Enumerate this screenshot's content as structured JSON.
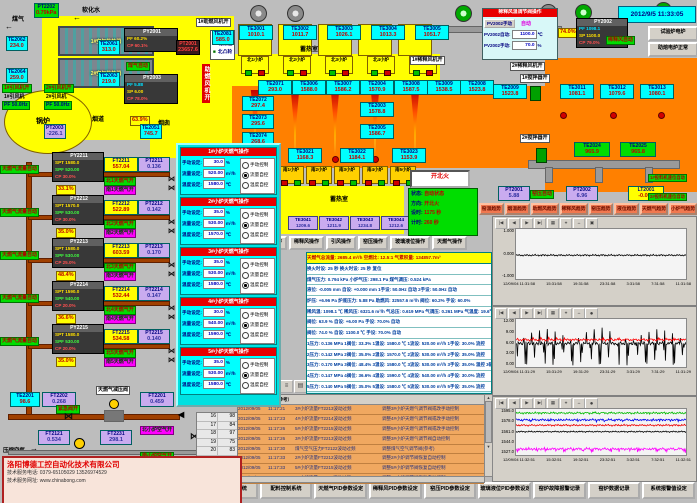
{
  "window": {
    "datetime": "2012/9/5 11:33:05"
  },
  "icons": {
    "left_arrow": "←",
    "right_arrow": "→",
    "pipe_arrow": "◀",
    "valve": "⋈",
    "marker": "▶",
    "up": "▲",
    "down": "▼",
    "left": "◀",
    "right": "▶",
    "record": "●"
  },
  "top_left": {
    "gas_label": "煤气",
    "water_label": "软化水",
    "boiler": "锅炉",
    "flue": "烟道",
    "chimney": "烟囱",
    "gas_auto": "煤气自动",
    "comb_fan_vert": "助燃风机开",
    "comb_fan1_on": "1#助燃风机开",
    "pt2202": {
      "id": "PT2202",
      "v": "0.79kPa"
    },
    "hx1": "1#空气换热器",
    "hx2": "2#空气换热器",
    "te2062": {
      "id": "TE2062",
      "v": "234.0"
    },
    "te2061": {
      "id": "TE2061",
      "v": "313.0"
    },
    "te2064": {
      "id": "TE2064",
      "v": "259.0"
    },
    "te2063": {
      "id": "TE2063",
      "v": "219.0"
    },
    "fan1_on": "1#引风机开",
    "fan2_on": "2#引风机开",
    "fan1": "1#引风机",
    "fan2": "2#引风机",
    "pf1": "PF 50.0Hz",
    "pf2": "PF 50.0Hz",
    "py2001": {
      "id": "PY2001",
      "r1": "PF 60.2%",
      "r2": "CP 60.1%"
    },
    "pt2001": {
      "id": "PT2001",
      "v": "23657.6"
    },
    "py2003": {
      "id": "PY2003",
      "r1": "PF 5.88",
      "r2": "SP 6.00",
      "r3": "CP 78.0%"
    },
    "valve_pos": "63.9%",
    "legend": [
      {
        "sq": "□",
        "t": "北行程"
      },
      {
        "sq": "□",
        "t": "北限位"
      },
      {
        "sq": "■",
        "t": "北凸轮"
      }
    ],
    "pt2003": {
      "id": "PT2003",
      "v": "-226.1"
    },
    "te2051": {
      "id": "TE2051",
      "v": "745.7"
    }
  },
  "regenerator": {
    "label": "蓄热室",
    "te2081": {
      "id": "TE2081",
      "v": "585.0"
    },
    "chambers": [
      {
        "id": "TE3001",
        "v": "1010.1"
      },
      {
        "id": "TE3002",
        "v": "1011.7"
      },
      {
        "id": "TE3003",
        "v": "1026.1"
      },
      {
        "id": "TE3004",
        "v": "1013.3"
      },
      {
        "id": "TE3005",
        "v": "1051.7"
      }
    ],
    "north_burners": [
      "北1小炉",
      "北2小炉",
      "北3小炉",
      "北4小炉",
      "北5小炉"
    ]
  },
  "furnace": {
    "top_sensors": [
      {
        "id": "TE2071",
        "v": "293.0"
      },
      {
        "id": "TE3006",
        "v": "1588.0"
      },
      {
        "id": "TE3007",
        "v": "1586.2"
      },
      {
        "id": "TE2004",
        "v": "1570.9"
      },
      {
        "id": "TE3008",
        "v": "1587.5"
      },
      {
        "id": "TE3009",
        "v": "1538.5"
      },
      {
        "id": "TE2008",
        "v": "1523.8"
      },
      {
        "id": "TE2009",
        "v": "1523.8"
      }
    ],
    "stack_sensors": [
      {
        "id": "TE2003",
        "v": "1578.8"
      },
      {
        "id": "TE2005",
        "v": "1586.7"
      }
    ],
    "left_sensors": [
      {
        "id": "TE2072",
        "v": "297.4"
      },
      {
        "id": "TE2073",
        "v": "295.6"
      },
      {
        "id": "TE2074",
        "v": "268.6"
      }
    ],
    "right_sensors": [
      {
        "id": "TE3011",
        "v": "1081.1"
      },
      {
        "id": "TE3012",
        "v": "1079.6"
      },
      {
        "id": "TE3013",
        "v": "1080.1"
      }
    ],
    "green_sensors": [
      {
        "id": "TE2024",
        "v": "965.9"
      },
      {
        "id": "TE2025",
        "v": "965.8"
      }
    ],
    "south_top_sensors": [
      {
        "id": "TE3021",
        "v": "1168.3"
      },
      {
        "id": "TE3022",
        "v": "1184.1"
      },
      {
        "id": "TE3023",
        "v": "1153.9"
      }
    ],
    "south_burners": [
      "南1小炉",
      "南2小炉",
      "南3小炉",
      "南4小炉",
      "南5小炉"
    ],
    "south_regen_label": "蓄热室",
    "purple_sensors": [
      {
        "id": "TE3041",
        "v": "1209.6"
      },
      {
        "id": "TE3042",
        "v": "1211.9"
      },
      {
        "id": "TE3043",
        "v": "1234.8"
      },
      {
        "id": "TE3044",
        "v": "1212.6"
      },
      {
        "id": "TE3045",
        "v": "1251.6"
      }
    ]
  },
  "right_top": {
    "dilution_panel": {
      "title": "稀释风温调节阀操作",
      "manual_btn": "PV2002手动",
      "auto_label": "自动",
      "row1_k": "PV2002自动:",
      "row1_v": "1100.0",
      "row1_u": "℃",
      "row2_k": "PV2002手动:",
      "row2_v": "70.0",
      "row2_u": "%"
    },
    "valve_pos": "74.0%",
    "pt2002a": {
      "id": "PT2002",
      "v": "6321.6"
    },
    "py2002": {
      "id": "PY2002",
      "r1": "PF 1098.1",
      "r2": "SP 1100.0",
      "r3": "CP 79.0%"
    },
    "dilution_auto": "稀释风自动",
    "fan1_on": "1#稀释风机开",
    "fan2_on": "2#稀释风机开",
    "stir1_on": "1#搅拌器开",
    "stir2_on": "2#搅拌器开",
    "test_btn": "试验炉电炉",
    "melt_btn": "助熔电炉正常",
    "pt2001": {
      "id": "PT2001",
      "v": "5.88"
    },
    "kiln_auto": "窑压自动",
    "pt2002b": {
      "id": "PT2002",
      "v": "6.96"
    },
    "lt2001": {
      "id": "LT2001",
      "v": "-0.001"
    },
    "feeder1": "1#投料机速位自动",
    "feeder2": "2#投料机速位自动"
  },
  "gas_rows": [
    {
      "auto": "天燃气流量自动",
      "py": {
        "id": "PY2211",
        "spt": "SPT 1580.0",
        "spf": "SPF 520.00",
        "cp": "CP 30.0%"
      },
      "ft": {
        "id": "FT2211",
        "v": "557.04"
      },
      "pt": {
        "id": "PT2211",
        "v": "0.136"
      },
      "north": "北1天燃气开",
      "south": "南1天燃气开",
      "pos": "33.1%"
    },
    {
      "auto": "天燃气流量自动",
      "py": {
        "id": "PY2212",
        "spt": "SPT 1570.0",
        "spf": "SPF 530.00",
        "cp": "CP 30.0%"
      },
      "ft": {
        "id": "FT2212",
        "v": "522.89"
      },
      "pt": {
        "id": "PT2212",
        "v": "0.142"
      },
      "north": "北2天燃气开",
      "south": "南2天燃气开",
      "pos": "35.0%"
    },
    {
      "auto": "天燃气流量自动",
      "py": {
        "id": "PY2213",
        "spt": "SPT 1580.0",
        "spf": "SPF 530.00",
        "cp": "CP 25.0%"
      },
      "ft": {
        "id": "FT2213",
        "v": "603.59"
      },
      "pt": {
        "id": "PT2213",
        "v": "0.170"
      },
      "north": "北3天燃气开",
      "south": "南3天燃气开",
      "pos": "48.4%"
    },
    {
      "auto": "天燃气流量自动",
      "py": {
        "id": "PY2214",
        "spt": "SPT 1590.0",
        "spf": "SPF 540.00",
        "cp": "CP 20.0%"
      },
      "ft": {
        "id": "FT2214",
        "v": "532.44"
      },
      "pt": {
        "id": "PT2214",
        "v": "0.147"
      },
      "north": "北4天燃气开",
      "south": "南4天燃气开",
      "pos": "36.6%"
    },
    {
      "auto": "天燃气流量自动",
      "py": {
        "id": "PY2215",
        "spt": "SPT 1580.0",
        "spf": "SPF 530.00",
        "cp": "CP 20.0%"
      },
      "ft": {
        "id": "FT2215",
        "v": "534.58"
      },
      "pt": {
        "id": "PT2215",
        "v": "0.140"
      },
      "north": "北5天燃气开",
      "south": "南5天燃气开",
      "pos": "35.0%"
    }
  ],
  "bottom_pipes": {
    "te2201": {
      "id": "TE2201",
      "v": "98.6"
    },
    "ft2202": {
      "id": "FT2202",
      "v": "0.268"
    },
    "emergency": "紧急阀开",
    "reducer": "天燃气减压阀",
    "ft2201": {
      "id": "FT2201",
      "v": "0.459"
    },
    "air_label": "压缩空气",
    "ft2121": {
      "id": "FT2121",
      "v": "0.534"
    },
    "ft2231": {
      "id": "FT2231",
      "v": "298.1"
    },
    "north_air": "北小炉空气开",
    "south_air": "南小炉空气开"
  },
  "company": {
    "name": "洛阳博德工控自动化技术有限公司",
    "phone": "技术服务电话: 0379-65105029  13526974529",
    "web": "技术服务网址: www.chinabong.com"
  },
  "popup": {
    "option_labels": [
      "手动控制",
      "流量自控",
      "温度自控"
    ],
    "field_labels": {
      "manual": "手动设定:",
      "flow": "流量设定:",
      "temp": "温度设定:"
    },
    "units": {
      "manual": "%",
      "flow": "m³/h",
      "temp": "℃"
    },
    "panels": [
      {
        "title": "1#小炉天燃气操作",
        "manual": "30.0",
        "flow": "520.00",
        "temp": "1580.0",
        "m0": "",
        "m1": "sel",
        "m2": ""
      },
      {
        "title": "2#小炉天燃气操作",
        "manual": "35.0",
        "flow": "530.00",
        "temp": "1570.0",
        "m0": "",
        "m1": "sel",
        "m2": ""
      },
      {
        "title": "3#小炉天燃气操作",
        "manual": "35.0",
        "flow": "530.00",
        "temp": "1580.0",
        "m0": "",
        "m1": "",
        "m2": "sel"
      },
      {
        "title": "4#小炉天燃气操作",
        "manual": "30.0",
        "flow": "540.00",
        "temp": "1590.0",
        "m0": "",
        "m1": "sel",
        "m2": ""
      },
      {
        "title": "5#小炉天燃气操作",
        "manual": "35.0",
        "flow": "530.00",
        "temp": "1580.0",
        "m0": "",
        "m1": "sel",
        "m2": ""
      }
    ]
  },
  "mid": {
    "fire_btn": "开北火",
    "status": [
      {
        "k": "状态:",
        "v": "自动状态"
      },
      {
        "k": "方向:",
        "v": "开北火"
      },
      {
        "k": "设时:",
        "v": "1175 秒"
      },
      {
        "k": "计时:",
        "v": "260 秒"
      }
    ],
    "op_buttons": [
      "助燃风操作",
      "稀释风操作",
      "引风操作",
      "窑压操作",
      "玻璃液位操作",
      "天燃气操作"
    ]
  },
  "summary": {
    "header": "天燃气总流量: 2685.4 m³/h   空燃比: 12.5:1   气累积量: 134857.7m³",
    "rows": [
      "换火时设: 25 秒    换火时设: 25 秒    复位",
      "煤气压力: 0.794 kPa   小炉气压: 298.1 Pa   煤气调压: 0.524 kPa",
      "液位: -0.005 mm   自设: +0.000 mm   1手设: 50.0Hz 自动   2手设: 50.0Hz 自动",
      "炉压: +6.96 Pa   炉底压力: 5.88 Pa   助燃风: 32557.6 m³/h   阀位: 60.2%   手设: 60.0%",
      "稀风温: 1098.1 ℃   稀风压: 6321.6 m³/h   气总压: 0.619 MPa   气调压: 0.261 MPa   气温度: 19.6℃",
      "阀位: 63.9 %   自设: +6.00 Pa   手设: 70.0%   自动",
      "阀位: 74.0 %   自设: 1100.0 ℃   手设: 70.0%   自动",
      "1压力: 0.136 MPa  1阀位: 33.3%  1温设: 1580.0 ℃  1流设: 520.00 m³/h  1手设: 30.0%  流控",
      "2压力: 0.142 MPa  2阀位: 35.0%  2温设: 1570.0 ℃  2流设: 530.00 m³/h  2手设: 35.0%  流控",
      "3压力: 0.170 MPa  3阀位: 48.4%  3温设: 1580.0 ℃  3流设: 530.00 m³/h  3手设: 35.0%  温控  3碹顶温度=1586.7℃",
      "4压力: 0.147 MPa  4阀位: 36.6%  4温设: 1590.0 ℃  4流设: 540.00 m³/h  4手设: 30.0%  流控",
      "5压力: 0.140 MPa  5阀位: 35.0%  5温设: 1580.0 ℃  5流设: 530.00 m³/h  5手设: 35.0%  流控"
    ]
  },
  "alarm": {
    "mini": [
      {
        "a": "16",
        "b": "98"
      },
      {
        "a": "17",
        "b": "84"
      },
      {
        "a": "18",
        "b": "97"
      },
      {
        "a": "19",
        "b": "75"
      },
      {
        "a": "20",
        "b": "83"
      },
      {
        "a": "21",
        "b": "85"
      },
      {
        "a": "22",
        "b": "81"
      },
      {
        "a": "23",
        "b": "83"
      }
    ],
    "headers": {
      "point": "故障点",
      "reason": "故障原因（供参考）"
    },
    "rows": [
      {
        "d": "2012/09/05",
        "t": "11:17:21",
        "p": "3#小炉流量FT2213波动过频",
        "r": "调整3#小炉天燃气调节阀或改手动控制"
      },
      {
        "d": "2012/09/05",
        "t": "11:17:23",
        "p": "4#小炉流量FT2214波动过频",
        "r": "调整4#小炉天燃气调节阀或改手动控制"
      },
      {
        "d": "2012/09/05",
        "t": "11:17:26",
        "p": "5#小炉流量FT2215波动过频",
        "r": "调整5#小炉天燃气调节阀或改手动控制"
      },
      {
        "d": "2012/09/05",
        "t": "11:17:26",
        "p": "3#小炉流量FT2213波动过频",
        "r": "调整3#小炉天燃气调节阀自动控制"
      },
      {
        "d": "2012/09/05",
        "t": "11:17:30",
        "p": "煤气空气压力FT2122波动过频",
        "r": "调整煤气空气调节阀(参考)"
      },
      {
        "d": "2012/09/05",
        "t": "11:17:33",
        "p": "2#小炉流量FT2212波动过频",
        "r": "调整2#小炉调节阀恢复自动控制"
      },
      {
        "d": "2012/09/05",
        "t": "11:17:33",
        "p": "5#小炉流量FT2215波动过频",
        "r": "调整5#小炉调节阀恢复自动控制"
      },
      {
        "d": "2012/09/05",
        "t": "11:17:33",
        "p": "1#小炉流量FT2211波动过频",
        "r": "调整1#小炉调节阀恢复自动控制"
      }
    ]
  },
  "toolbar": {
    "icons": [
      {
        "g": "≡",
        "n": "menu-icon"
      },
      {
        "g": "▤",
        "n": "rows-icon"
      },
      {
        "g": "?",
        "n": "help-icon"
      },
      {
        "g": "▣",
        "n": "save-icon"
      },
      {
        "g": "▦",
        "n": "grid-icon"
      },
      {
        "g": "▥",
        "n": "columns-icon"
      },
      {
        "g": "▧",
        "n": "shade-icon"
      },
      {
        "g": "◫",
        "n": "window-icon"
      },
      {
        "g": "⊞",
        "n": "add-window-icon"
      },
      {
        "g": "↕",
        "n": "sort-icon"
      },
      {
        "g": "⊕",
        "n": "zoom-icon"
      },
      {
        "g": "×",
        "n": "close-icon"
      }
    ]
  },
  "chart_tools": [
    "|◀",
    "◀",
    "▶",
    "▶|",
    "▦",
    "⌖",
    "↔",
    "▣"
  ],
  "trend_buttons": [
    "窑温趋势",
    "烟温趋势",
    "助燃风趋势",
    "稀释风趋势",
    "窑压趋势",
    "液位趋势",
    "天燃气趋势",
    "小炉气趋势"
  ],
  "chart_data": [
    {
      "type": "line",
      "title": "窑压趋势",
      "ylim": [
        -1,
        1
      ],
      "yticks": [
        "1.000",
        "0.000",
        "-1.000"
      ],
      "xticks": [
        "12/09/04 11:31:58",
        "15:31:58",
        "19:31:58",
        "23:31:58",
        "3:31:58",
        "7:31:58",
        "11:31:58"
      ],
      "grid": false,
      "legend": "none",
      "series": [
        {
          "name": "窑压 PT2001",
          "color": "#000000",
          "mean": -0.05,
          "amplitude": 0.04,
          "spikes": 0
        }
      ]
    },
    {
      "type": "line",
      "title": "炉压/稀释风压趋势",
      "ylim": [
        0,
        12
      ],
      "yticks": [
        "12.00",
        "9.00",
        "6.00",
        "3.00",
        "0.00"
      ],
      "xticks": [
        "12/09/04 11:31:29",
        "15:31:29",
        "19:31:29",
        "23:31:29",
        "3:31:29",
        "7:31:29",
        "11:31:29"
      ],
      "grid": false,
      "legend": "none",
      "series": [
        {
          "name": "黑",
          "color": "#000000",
          "mean": 5.9,
          "amplitude": 0.5,
          "spikes": 5.5,
          "spikes_up": 3.5
        },
        {
          "name": "红",
          "color": "#ff0000",
          "mean": 6.8,
          "amplitude": 0.35,
          "spikes": 0,
          "spikes_up": 0.6
        }
      ]
    },
    {
      "type": "line",
      "title": "窑温趋势",
      "ylim": [
        1527,
        1595
      ],
      "yticks": [
        "1595.0",
        "1578.0",
        "1561.0",
        "1544.0",
        "1527.0"
      ],
      "xticks": [
        "12/09/04 11:32:51",
        "15:32:51",
        "19:32:51",
        "23:32:51",
        "3:32:51",
        "7:32:51",
        "11:32:51"
      ],
      "grid": false,
      "legend": "none",
      "series": [
        {
          "name": "绿",
          "color": "#00bb00",
          "mean": 1589,
          "amplitude": 1.8,
          "spikes": 0,
          "spikes_up": 1.5
        },
        {
          "name": "蓝",
          "color": "#0000ee",
          "mean": 1579,
          "amplitude": 1.8,
          "spikes": 2,
          "spikes_up": 0
        },
        {
          "name": "红",
          "color": "#ee0000",
          "mean": 1571,
          "amplitude": 1.6,
          "spikes": 0,
          "spikes_up": 0
        },
        {
          "name": "黑",
          "color": "#000000",
          "mean": 1561.5,
          "amplitude": 1.2,
          "spikes": 0,
          "spikes_up": 0
        },
        {
          "name": "紫",
          "color": "#ff00ff",
          "mean": 1536,
          "amplitude": 2.2,
          "spikes": 4,
          "spikes_up": 0
        }
      ]
    }
  ],
  "nav_buttons": [
    "窑炉控制系统",
    "配料控制系统",
    "天燃气PID参数设定",
    "稀释风PID参数设定",
    "窑压PID参数设定",
    "玻璃液位PID参数设定",
    "窑炉故障报警记录",
    "窑炉数据记录",
    "系统报警值设定"
  ]
}
